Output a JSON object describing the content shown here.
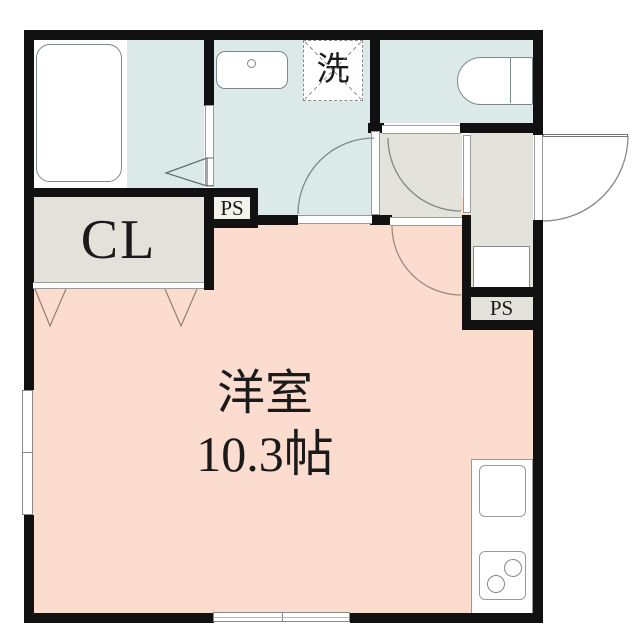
{
  "labels": {
    "closet": "CL",
    "pipe_space_upper": "PS",
    "pipe_space_lower": "PS",
    "washing_machine": "洗",
    "room_name": "洋室",
    "room_size": "10.3帖"
  },
  "colors": {
    "wall": "#111111",
    "wet_area_fill": "#dbe9e8",
    "entrance_fill": "#e4e3db",
    "closet_fill": "#e2e1da",
    "main_room_fill": "#fbdcce",
    "fixture_outline": "#7b8a89",
    "door_swing_arc": "#8a8a8a",
    "hanger_mark": "#9b7a6f"
  },
  "fixtures": {
    "bathtub": "bathtub-icon",
    "washbasin": "washbasin-icon",
    "washing_machine_space": "washing-machine-dashed-box",
    "toilet": "toilet-icon",
    "shoe_cabinet": "shoe-cabinet-box",
    "kitchen_sink": "kitchen-sink-icon",
    "stove": "two-burner-stove-icon"
  }
}
